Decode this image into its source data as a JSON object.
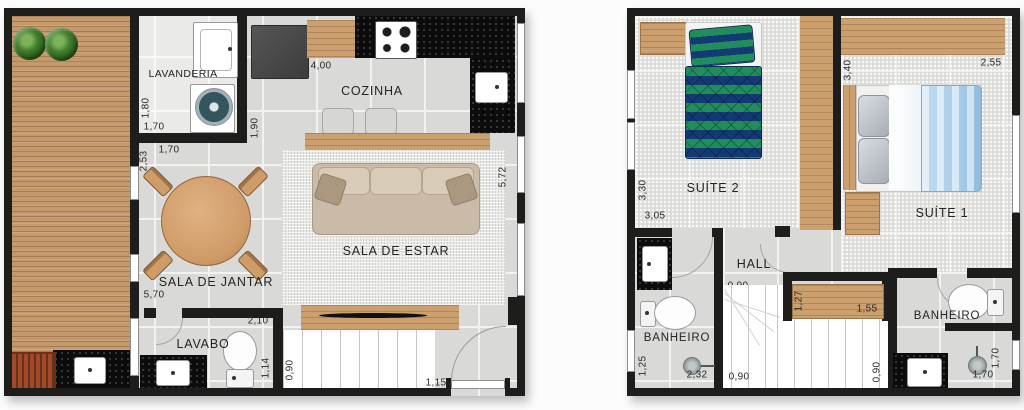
{
  "plans": {
    "ground": {
      "name": "Ground floor plan",
      "rooms": {
        "lavanderia": "LAVANDERIA",
        "cozinha": "COZINHA",
        "sala_de_estar": "SALA DE ESTAR",
        "sala_de_jantar": "SALA DE JANTAR",
        "lavabo": "LAVABO"
      },
      "dims": {
        "lavanderia_h": "1,80",
        "lavanderia_w": "1,70",
        "jantar_wall_h": "2,53",
        "jantar_wall_w": "1,70",
        "cozinha_w": "4,00",
        "cozinha_h": "1,90",
        "estar_h": "5,72",
        "jantar_h": "5,70",
        "lavabo_w": "2,10",
        "lavabo_h": "1,14",
        "stairs_w": "0,90",
        "entry_w": "1,15"
      },
      "furniture": [
        "plants",
        "barbecue-grill",
        "deck-sink",
        "laundry-tub",
        "washing-machine",
        "refrigerator",
        "cooktop",
        "kitchen-sink",
        "bar-counter",
        "bar-stools",
        "sofa",
        "rug",
        "dining-table",
        "dining-chairs",
        "tv-stand",
        "tv",
        "lavabo-sink",
        "toilet",
        "staircase",
        "entry-door"
      ]
    },
    "upper": {
      "name": "Upper floor plan",
      "rooms": {
        "suite2": "SUÍTE 2",
        "suite1": "SUÍTE 1",
        "hall": "HALL",
        "banheiro_left": "BANHEIRO",
        "banheiro_right": "BANHEIRO"
      },
      "dims": {
        "suite2_h": "3,30",
        "suite2_w": "3,05",
        "suite1_h": "3,40",
        "suite1_w": "2,55",
        "hall_w": "0,90",
        "closet_h": "1,27",
        "closet_w": "1,55",
        "banheiro_left_h": "1,25",
        "banheiro_left_w": "2,32",
        "stairs_w": "0,90",
        "stairs_side_h": "0,90",
        "banheiro_right_h": "1,70",
        "banheiro_right_w": "1,70"
      },
      "furniture": [
        "single-bed",
        "nightstand",
        "wardrobe",
        "double-bed",
        "hall-closet",
        "toilet",
        "bathroom-sink",
        "shower",
        "staircase"
      ]
    }
  },
  "colors": {
    "wall": "#1d1d1b",
    "floor_tile": "#d9d9d8",
    "deck_wood": "#c49a6c",
    "furniture_wood": "#cb9f6e",
    "granite": "#0c0c0c",
    "sofa": "#c9bba7",
    "bed_green": "#1f8e5c",
    "bed_navy": "#143a75",
    "bed_blue": "#a9cde9",
    "plant_green": "#3f7d2c",
    "grill_brick": "#a14a2a"
  }
}
